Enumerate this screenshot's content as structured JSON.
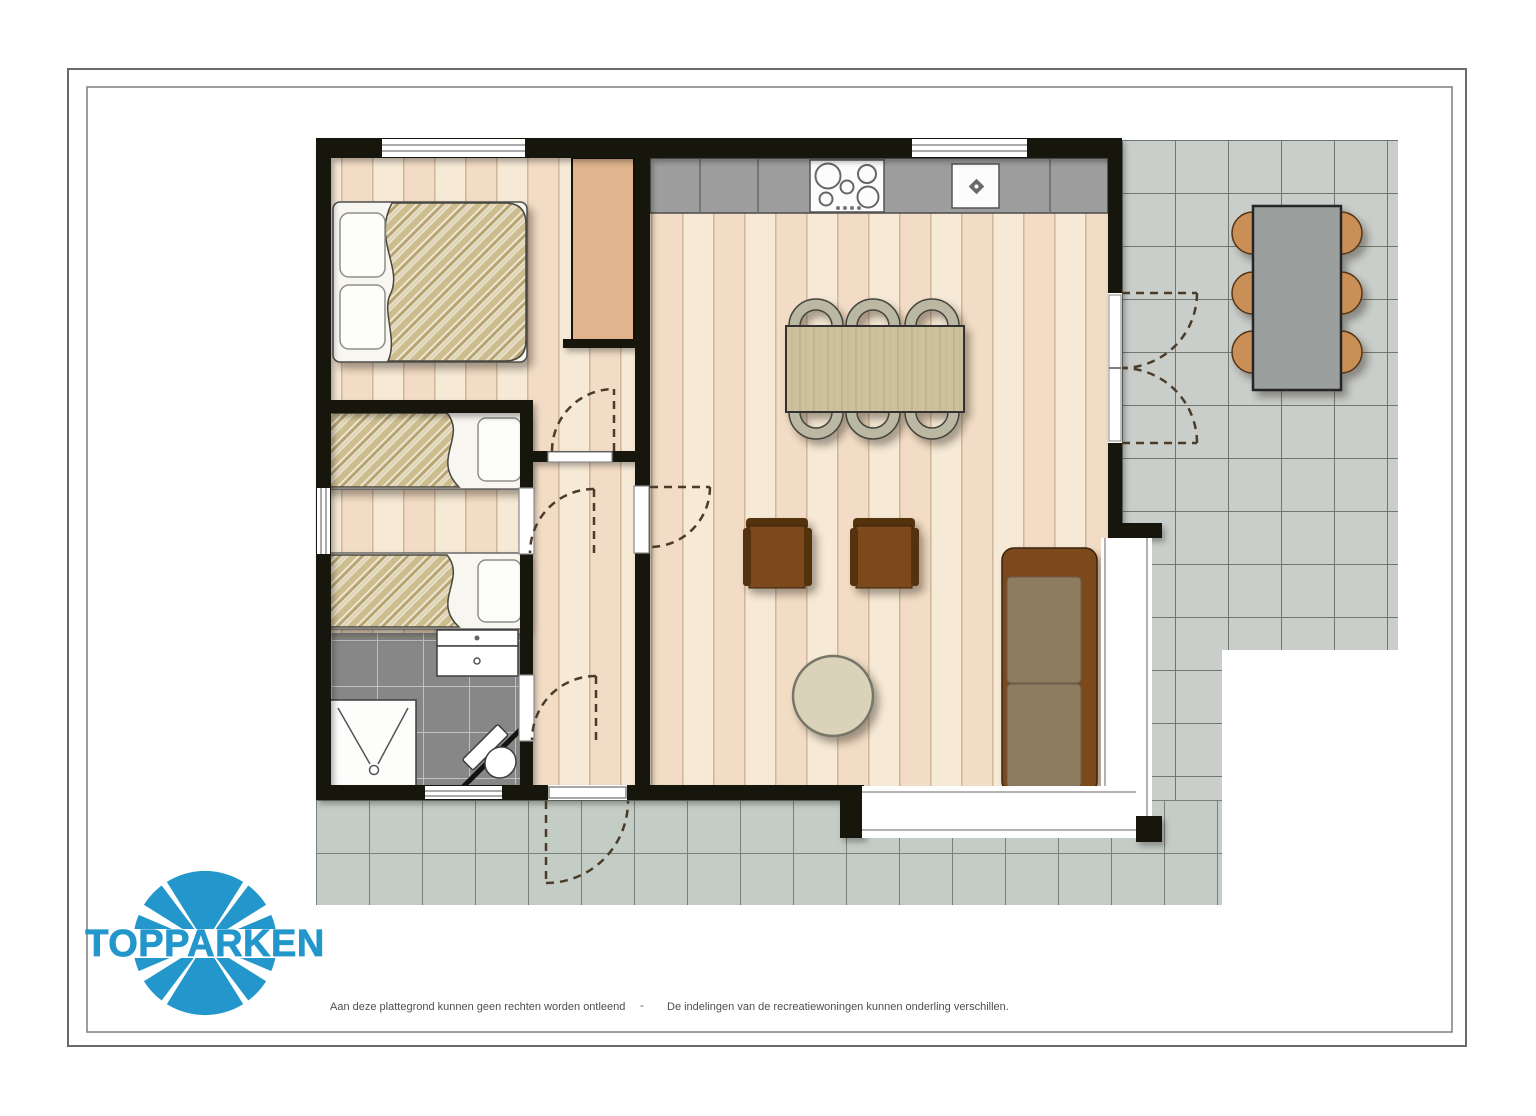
{
  "logo": {
    "text": "TOPPARKEN",
    "color": "#2397cc"
  },
  "footer": {
    "left_disclaimer": "Aan deze plattegrond kunnen geen rechten worden ontleend",
    "separator": "-",
    "right_disclaimer": "De indelingen van de recreatiewoningen kunnen onderling verschillen."
  },
  "palette": {
    "wall": "#141210",
    "plank_light": "#f6e9d6",
    "plank_dark": "#f2dcc5",
    "plank_line": "#cdb296",
    "bath_tile": "#878787",
    "bath_grout": "#c0c0c0",
    "terrace_tile_right": "#c9cecb",
    "terrace_grout_right": "#6f7773",
    "terrace_tile_front": "#c4ccc6",
    "terrace_grout_front": "#78817c",
    "counter": "#9e9e9e",
    "closet": "#e0b48d",
    "table_wood": "#cdc09c",
    "sofa_frame": "#7b4a1e",
    "sofa_cushion": "#8d7b60",
    "armchair_frame": "#53300f",
    "armchair_seat": "#7b4a1e",
    "dining_chair": "#bab7a3",
    "outdoor_chair": "#c98f57",
    "outdoor_table": "#9b9f9d",
    "blanket_tan": "#cdbc8e",
    "door_arc": "#4b3c2a",
    "frame_border": "#6a6a6a"
  },
  "floorplan": {
    "rooms": [
      "bedroom-1",
      "bedroom-2",
      "bathroom",
      "hallway",
      "living-room-kitchen",
      "terrace-right",
      "terrace-front"
    ],
    "furniture": [
      "double-bed",
      "wardrobe-closet",
      "single-bed",
      "single-bed",
      "vanity-sink",
      "shower",
      "toilet",
      "kitchen-counter",
      "cooktop",
      "kitchen-sink",
      "dining-table",
      "dining-chairs-6",
      "armchair",
      "armchair",
      "coffee-table",
      "sofa",
      "outdoor-table",
      "outdoor-chairs-6"
    ],
    "features": [
      "windows",
      "interior-doors",
      "front-door",
      "french-doors",
      "corner-glazing"
    ]
  }
}
